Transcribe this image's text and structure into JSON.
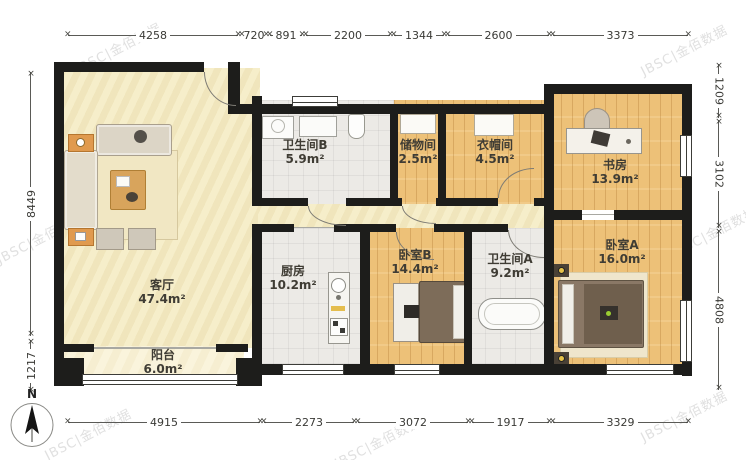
{
  "watermark": {
    "text": "JBSC|金佰数据",
    "color": "#e0e0e0"
  },
  "north": {
    "label": "N"
  },
  "rooms": [
    {
      "name": "客厅",
      "area": "47.4m²"
    },
    {
      "name": "阳台",
      "area": "6.0m²"
    },
    {
      "name": "卫生间B",
      "area": "5.9m²"
    },
    {
      "name": "储物间",
      "area": "2.5m²"
    },
    {
      "name": "衣帽间",
      "area": "4.5m²"
    },
    {
      "name": "书房",
      "area": "13.9m²"
    },
    {
      "name": "厨房",
      "area": "10.2m²"
    },
    {
      "name": "卧室B",
      "area": "14.4m²"
    },
    {
      "name": "卫生间A",
      "area": "9.2m²"
    },
    {
      "name": "卧室A",
      "area": "16.0m²"
    }
  ],
  "dims": {
    "top": [
      "4258",
      "720",
      "891",
      "2200",
      "1344",
      "2600",
      "3373"
    ],
    "bottom": [
      "4915",
      "2273",
      "3072",
      "1917",
      "3329"
    ],
    "left": [
      "8449",
      "1217"
    ],
    "right": [
      "1209",
      "3102",
      "4808"
    ]
  },
  "colors": {
    "wall": "#1d1d1b",
    "floor_wood": "#edc178",
    "floor_tile": "#eceae6",
    "floor_cream": "#f5ecc6",
    "label": "#3f3c34"
  }
}
